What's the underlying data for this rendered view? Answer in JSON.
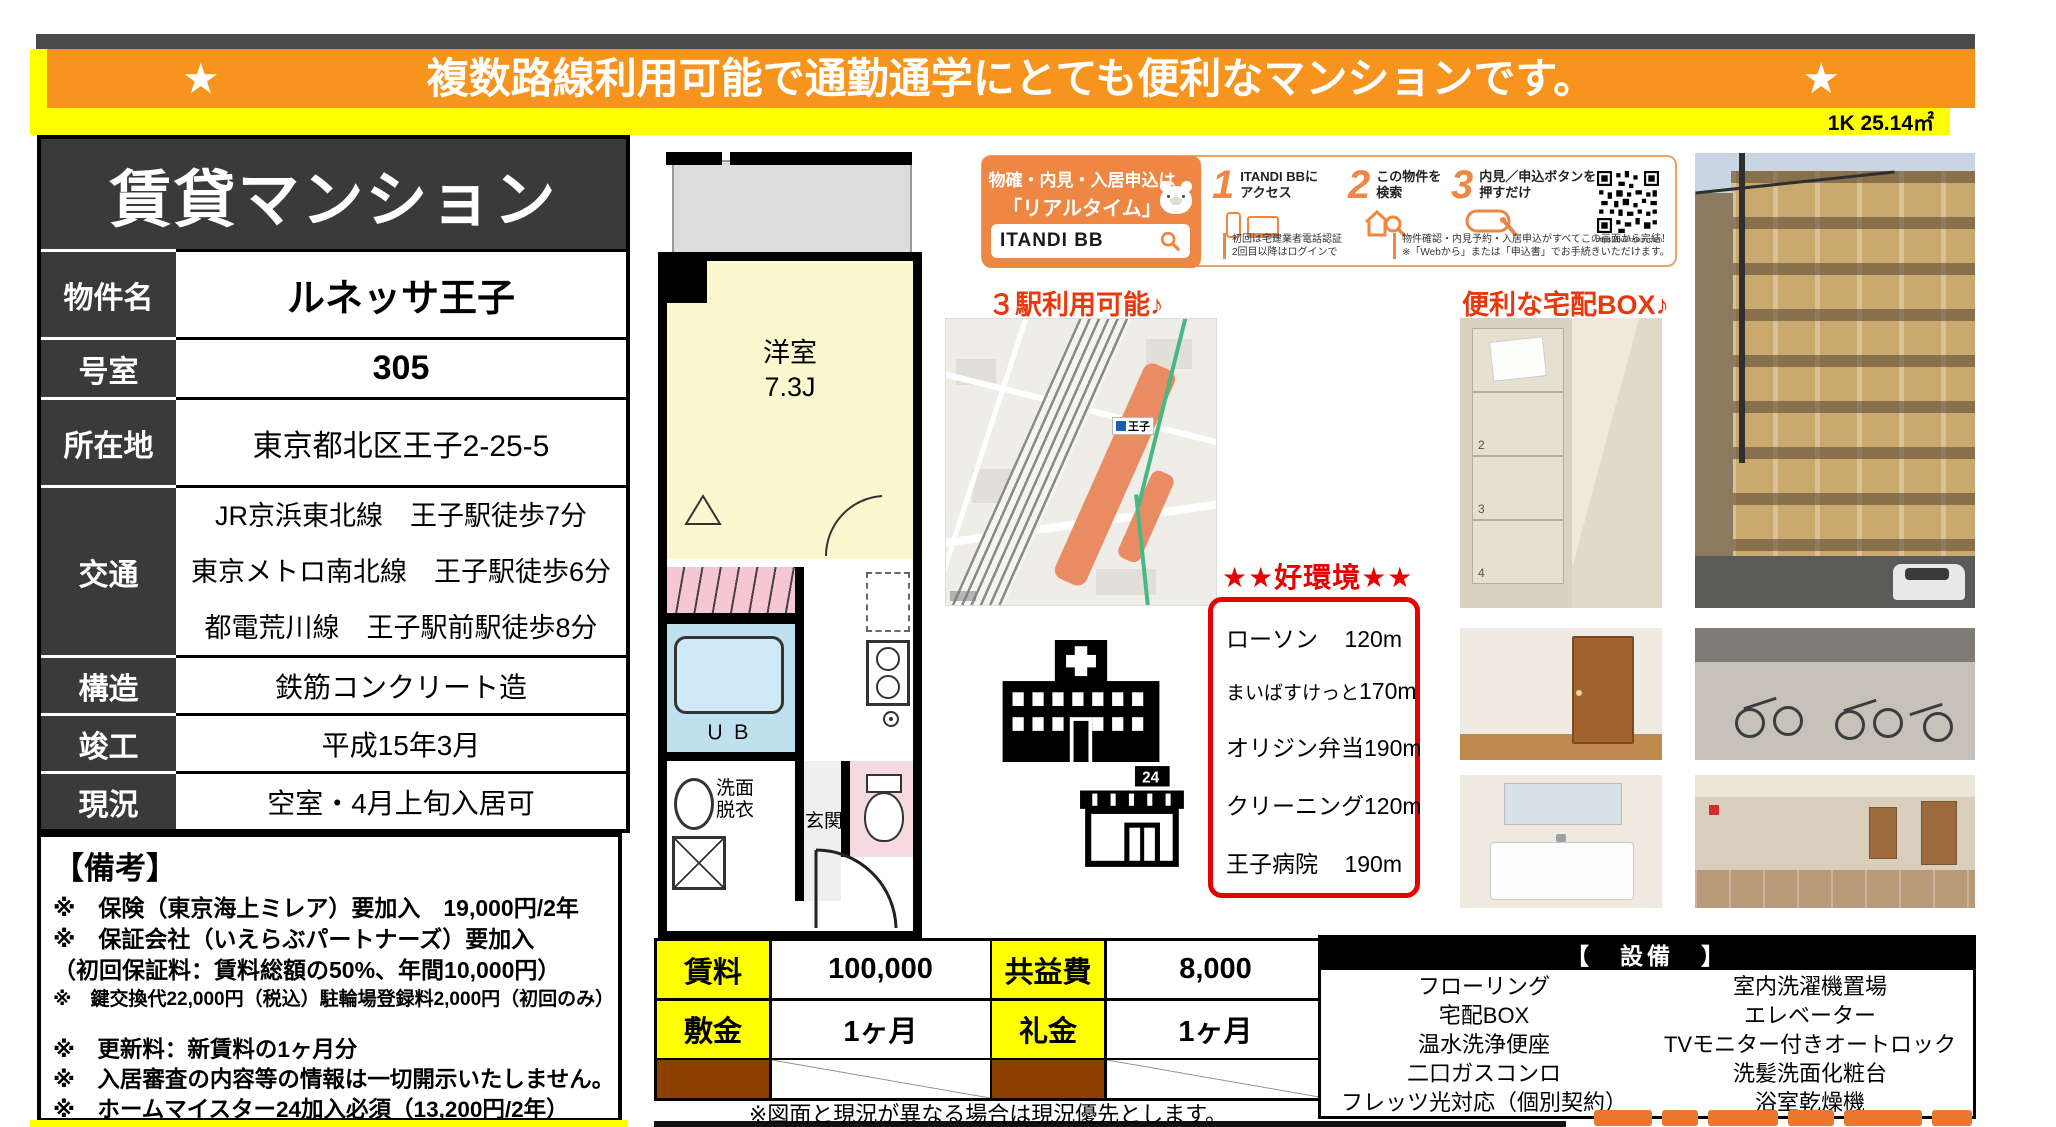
{
  "banner": {
    "star_left": "★",
    "text": "複数路線利用可能で通勤通学にとても便利なマンションです。",
    "star_right": "★"
  },
  "area_label": "1K 25.14㎡",
  "property_card": {
    "title": "賃貸マンション",
    "rows": {
      "name": {
        "label": "物件名",
        "value": "ルネッサ王子"
      },
      "room": {
        "label": "号室",
        "value": "305"
      },
      "address": {
        "label": "所在地",
        "value": "東京都北区王子2-25-5"
      },
      "access": {
        "label": "交通",
        "lines": [
          "JR京浜東北線　王子駅徒歩7分",
          "東京メトロ南北線　王子駅徒歩6分",
          "都電荒川線　王子駅前駅徒歩8分"
        ]
      },
      "structure": {
        "label": "構造",
        "value": "鉄筋コンクリート造"
      },
      "built": {
        "label": "竣工",
        "value": "平成15年3月"
      },
      "status": {
        "label": "現況",
        "value": "空室・4月上旬入居可"
      }
    }
  },
  "remarks": {
    "heading": "【備考】",
    "lines": [
      "※　保険（東京海上ミレア）要加入　19,000円/2年",
      "※　保証会社（いえらぶパートナーズ）要加入",
      "（初回保証料：賃料総額の50%、年間10,000円）",
      "※　鍵交換代22,000円（税込）駐輪場登録料2,000円（初回のみ）",
      "※　更新料：新賃料の1ヶ月分",
      "※　入居審査の内容等の情報は一切開示いたしません。",
      "※　ホームマイスター24加入必須（13,200円/2年）"
    ]
  },
  "floorplan": {
    "room_label": "洋室",
    "room_size": "7.3J",
    "bath_label": "ＵＢ",
    "washroom_line1": "洗面",
    "washroom_line2": "脱衣",
    "entrance_label": "玄関"
  },
  "itandi": {
    "left_line1": "物確・内見・入居申込は",
    "left_line2": "「リアルタイム」Web受付",
    "search_label": "ITANDI BB",
    "steps": [
      {
        "num": "1",
        "line1": "ITANDI BBに",
        "line2": "アクセス"
      },
      {
        "num": "2",
        "line1": "この物件を",
        "line2": "検索"
      },
      {
        "num": "3",
        "line1": "内見／申込ボタンを",
        "line2": "押すだけ"
      }
    ],
    "caption1_line1": "初回は宅建業者電話認証",
    "caption1_line2": "2回目以降はログインで",
    "caption2_line1": "物件確認・内見予約・入居申込がすべてこの画面から完結！",
    "caption2_line2": "※「Webから」または「申込書」でお手続きいただけます。",
    "qr_url": "https://bukkakun.com"
  },
  "map": {
    "caption": "３駅利用可能♪",
    "station_name": "王子"
  },
  "delivery": {
    "caption": "便利な宅配BOX♪",
    "locker_numbers": [
      "",
      "2",
      "3",
      "4"
    ]
  },
  "environment": {
    "title": "★★好環境★★",
    "items": [
      {
        "name": "ローソン",
        "distance": "120m"
      },
      {
        "name": "まいばすけっと",
        "distance": "170m"
      },
      {
        "name": "オリジン弁当",
        "distance": "190m"
      },
      {
        "name": "クリーニング",
        "distance": "120m"
      },
      {
        "name": "王子病院",
        "distance": "190m"
      }
    ]
  },
  "price_table": {
    "rent_label": "賃料",
    "rent_value": "100,000",
    "fee_label": "共益費",
    "fee_value": "8,000",
    "deposit_label": "敷金",
    "deposit_value": "1ヶ月",
    "key_label": "礼金",
    "key_value": "1ヶ月"
  },
  "facilities": {
    "header": "【　設備　】",
    "left": [
      "フローリング",
      "宅配BOX",
      "温水洗浄便座",
      "二口ガスコンロ",
      "フレッツ光対応（個別契約）"
    ],
    "right": [
      "室内洗濯機置場",
      "エレベーター",
      "TVモニター付きオートロック",
      "洗髪洗面化粧台",
      "浴室乾燥機"
    ]
  },
  "bottom_note": "※図面と現況が異なる場合は現況優先とします。",
  "store_sign": "24",
  "colors": {
    "banner_orange": "#f7941e",
    "highlight_yellow": "#ffff00",
    "red_accent": "#e8380d",
    "env_red": "#e60000",
    "itandi_orange": "#ee8743",
    "dark_cell": "#3a3a3a",
    "brown_cell": "#8b4000"
  }
}
